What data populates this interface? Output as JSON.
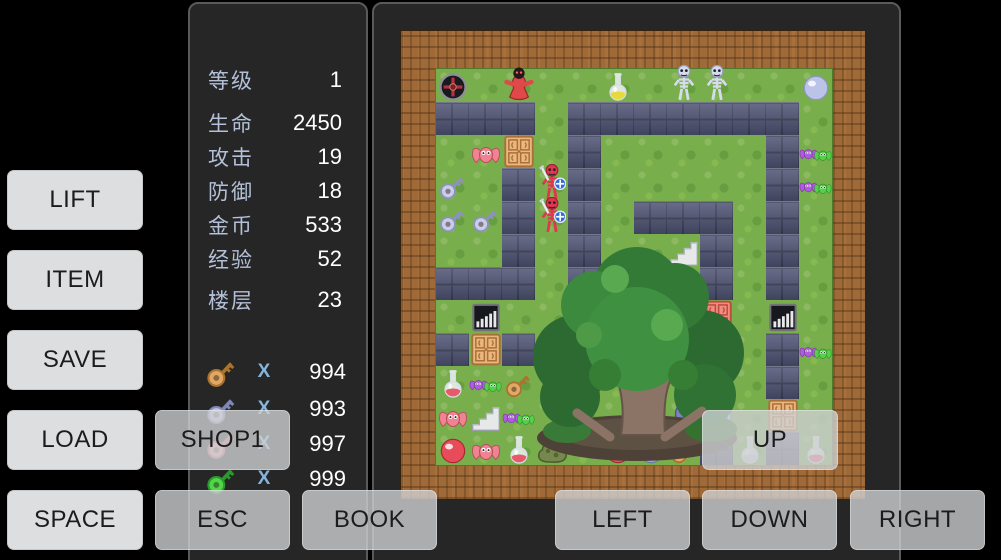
{
  "stats_panel": {
    "rows": [
      {
        "label": "等级",
        "value": "1"
      },
      {
        "label": "生命",
        "value": "2450"
      },
      {
        "label": "攻击",
        "value": "19"
      },
      {
        "label": "防御",
        "value": "18"
      },
      {
        "label": "金币",
        "value": "533"
      },
      {
        "label": "经验",
        "value": "52"
      },
      {
        "label": "楼层",
        "value": "23"
      }
    ],
    "keys": {
      "x_symbol": "X",
      "items": [
        {
          "name": "yellow-key",
          "color": "#e2a863",
          "dark": "#a8742f",
          "count": "994"
        },
        {
          "name": "blue-key",
          "color": "#bcc2e2",
          "dark": "#7f86b8",
          "count": "993"
        },
        {
          "name": "red-key",
          "color": "#eda0ac",
          "dark": "#c06575",
          "count": "997"
        },
        {
          "name": "green-key",
          "color": "#4fd649",
          "dark": "#2a9a2a",
          "count": "999"
        }
      ]
    }
  },
  "buttons": {
    "lift": "LIFT",
    "item": "ITEM",
    "save": "SAVE",
    "load": "LOAD",
    "space": "SPACE",
    "shop1": "SHOP1",
    "esc": "ESC",
    "book": "BOOK",
    "up": "UP",
    "left": "LEFT",
    "down": "DOWN",
    "right": "RIGHT"
  },
  "map": {
    "grid": [
      "o.g..y.ss..P",
      "###.#######.",
      ".bD.#.....#B",
      "K.#X#.....#B",
      "KK#X#.###.#.",
      "..#.#..T#.#.",
      "###.#...#.#.",
      ".G......R.G.",
      "#D#M......#B",
      "fBk.......#.",
      "bTB....NL.D.",
      "rbfM.ruk#w#f"
    ],
    "legend": {
      ".": "grass",
      "#": "wall",
      "o": "dark-orb",
      "g": "red-ghost",
      "y": "yellow-flask",
      "s": "skeleton",
      "P": "purple-orb",
      "b": "red-bat",
      "K": "white-key",
      "X": "red-skeleton",
      "B": "bat-pair",
      "D": "door-orange",
      "R": "door-red",
      "L": "door-blue",
      "G": "grating",
      "T": "stairs",
      "M": "rock",
      "f": "red-flask",
      "k": "tan-key",
      "r": "red-orb",
      "u": "blue-orb",
      "N": "blue-knight",
      "w": "white-flask"
    }
  },
  "colors": {
    "grass": "#79ae4c",
    "wall": "#4d5273",
    "frame_brown": "#a06a38",
    "panel_bg": "#262626",
    "panel_border": "#5a5a5a",
    "stat_label": "#b3c0d8",
    "stat_value": "#ffffff",
    "x_symbol": "#85b4dc",
    "button_bg": "#dcdedf",
    "overlay_button_bg": "rgba(206,208,210,0.8)",
    "button_text": "#1c1c1c"
  }
}
